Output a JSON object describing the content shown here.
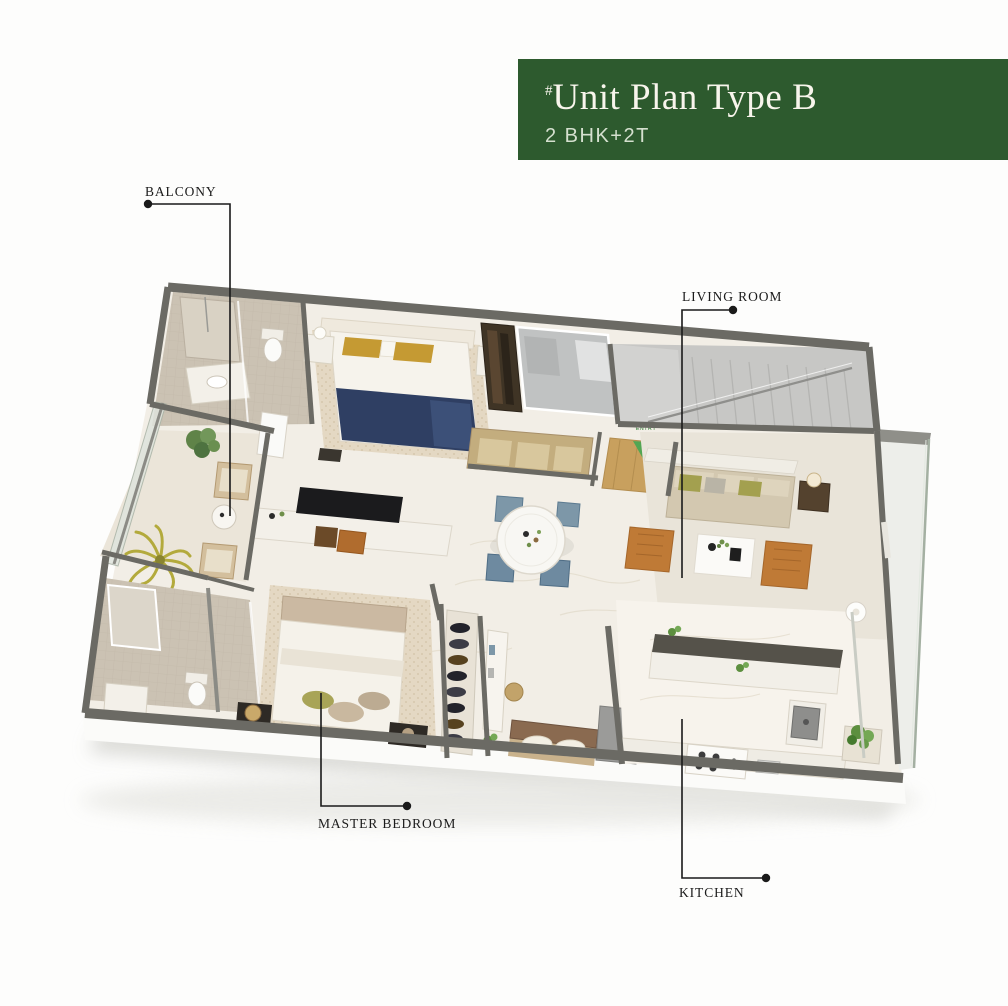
{
  "header": {
    "marker": "#",
    "title": "Unit Plan Type B",
    "subtitle": "2 BHK+2T"
  },
  "labels": {
    "balcony": "BALCONY",
    "living_room": "LIVING ROOM",
    "master_bedroom": "MASTER BEDROOM",
    "kitchen": "KITCHEN"
  },
  "plan": {
    "entry_label": "ENTRY"
  },
  "palette": {
    "header_green": "#2d5a2e",
    "header_title": "#f8f5ec",
    "header_subtitle": "#d5e0cf",
    "wall_gray": "#6b6a64",
    "floor_cream": "#f2eee6",
    "bath_tile": "#cbc2b3",
    "accent_orange": "#bf7a36",
    "navy_blanket": "#2f3f63",
    "gold_pillow": "#c59a33",
    "sofa_beige": "#d3c8b0",
    "entry_green": "#53a653",
    "label_color": "#1b1b1b"
  }
}
